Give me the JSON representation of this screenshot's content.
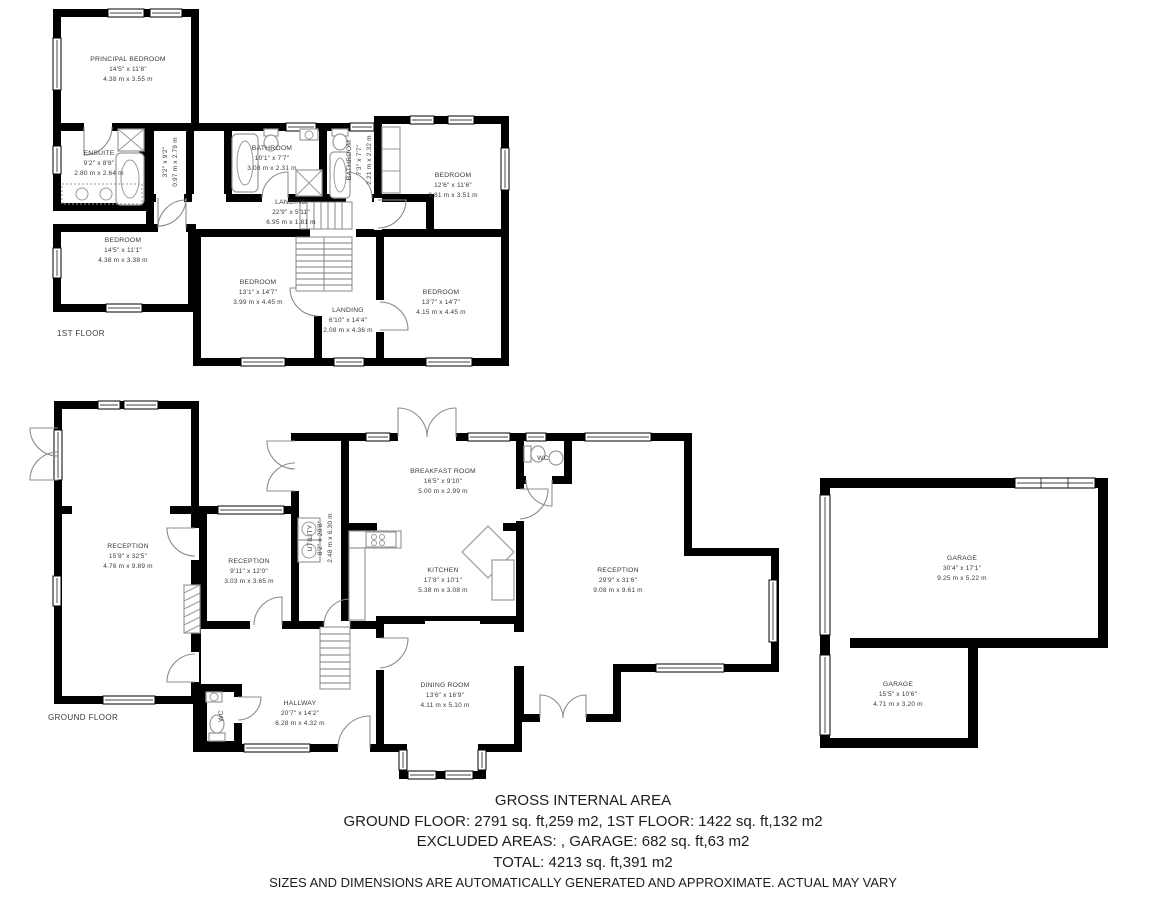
{
  "floors": {
    "first": {
      "label": "1ST FLOOR",
      "rooms": {
        "principal_bedroom": {
          "name": "PRINCIPAL BEDROOM",
          "size_ft": "14'5\" x 11'8\"",
          "size_m": "4.38 m x 3.55 m"
        },
        "ensuite": {
          "name": "ENSUITE",
          "size_ft": "9'2\" x 8'8\"",
          "size_m": "2.80 m x 2.64 m"
        },
        "corridor": {
          "name": "",
          "size_ft": "3'2\" x 9'2\"",
          "size_m": "0.97 m x 2.79 m"
        },
        "bathroom1": {
          "name": "BATHROOM",
          "size_ft": "10'1\" x 7'7\"",
          "size_m": "3.08 m x 2.31 m"
        },
        "bathroom2": {
          "name": "BATHROOM",
          "size_ft": "7'3\" x 7'7\"",
          "size_m": "2.21 m x 2.32 m"
        },
        "bedroom_tr": {
          "name": "BEDROOM",
          "size_ft": "12'6\" x 11'6\"",
          "size_m": "3.81 m x 3.51 m"
        },
        "landing_upper": {
          "name": "LANDING",
          "size_ft": "22'9\" x 5'11\"",
          "size_m": "6.95 m x 1.81 m"
        },
        "bedroom_bl": {
          "name": "BEDROOM",
          "size_ft": "14'5\" x 11'1\"",
          "size_m": "4.38 m x 3.38 m"
        },
        "bedroom_bm": {
          "name": "BEDROOM",
          "size_ft": "13'1\" x 14'7\"",
          "size_m": "3.99 m x 4.45 m"
        },
        "landing_lower": {
          "name": "LANDING",
          "size_ft": "6'10\" x 14'4\"",
          "size_m": "2.08 m x 4.36 m"
        },
        "bedroom_br": {
          "name": "BEDROOM",
          "size_ft": "13'7\" x 14'7\"",
          "size_m": "4.15 m x 4.45 m"
        }
      }
    },
    "ground": {
      "label": "GROUND FLOOR",
      "rooms": {
        "reception_left": {
          "name": "RECEPTION",
          "size_ft": "15'8\" x 32'5\"",
          "size_m": "4.76 m x 9.89 m"
        },
        "reception_small": {
          "name": "RECEPTION",
          "size_ft": "9'11\" x 12'0\"",
          "size_m": "3.03 m x 3.65 m"
        },
        "utility": {
          "name": "UTILITY",
          "size_ft": "8'2\" x 20'8\"",
          "size_m": "2.48 m x 6.30 m"
        },
        "breakfast_room": {
          "name": "BREAKFAST ROOM",
          "size_ft": "16'5\" x 9'10\"",
          "size_m": "5.00 m x 2.99 m"
        },
        "kitchen": {
          "name": "KITCHEN",
          "size_ft": "17'8\" x 10'1\"",
          "size_m": "5.38 m x 3.08 m"
        },
        "wc_breakfast": {
          "name": "WC"
        },
        "reception_main": {
          "name": "RECEPTION",
          "size_ft": "29'9\" x 31'6\"",
          "size_m": "9.08 m x 9.61 m"
        },
        "hallway": {
          "name": "HALLWAY",
          "size_ft": "20'7\" x 14'2\"",
          "size_m": "6.28 m x 4.32 m"
        },
        "dining_room": {
          "name": "DINING ROOM",
          "size_ft": "13'6\" x 16'9\"",
          "size_m": "4.11 m x 5.10 m"
        },
        "wc_hall": {
          "name": "WC"
        }
      }
    },
    "garage": {
      "rooms": {
        "garage_main": {
          "name": "GARAGE",
          "size_ft": "30'4\" x 17'1\"",
          "size_m": "9.25 m x 5.22 m"
        },
        "garage_small": {
          "name": "GARAGE",
          "size_ft": "15'5\" x 10'6\"",
          "size_m": "4.71 m x 3.20 m"
        }
      }
    }
  },
  "footer": {
    "title": "GROSS INTERNAL AREA",
    "line1": "GROUND FLOOR: 2791 sq. ft,259 m2, 1ST FLOOR: 1422 sq. ft,132 m2",
    "line2": "EXCLUDED AREAS: , GARAGE: 682 sq. ft,63 m2",
    "line3": "TOTAL: 4213 sq. ft,391 m2",
    "disclaimer": "SIZES AND DIMENSIONS ARE AUTOMATICALLY GENERATED AND APPROXIMATE. ACTUAL MAY VARY"
  },
  "colors": {
    "wall": "#000000",
    "background": "#ffffff",
    "label_text": "#3a3a3a"
  }
}
